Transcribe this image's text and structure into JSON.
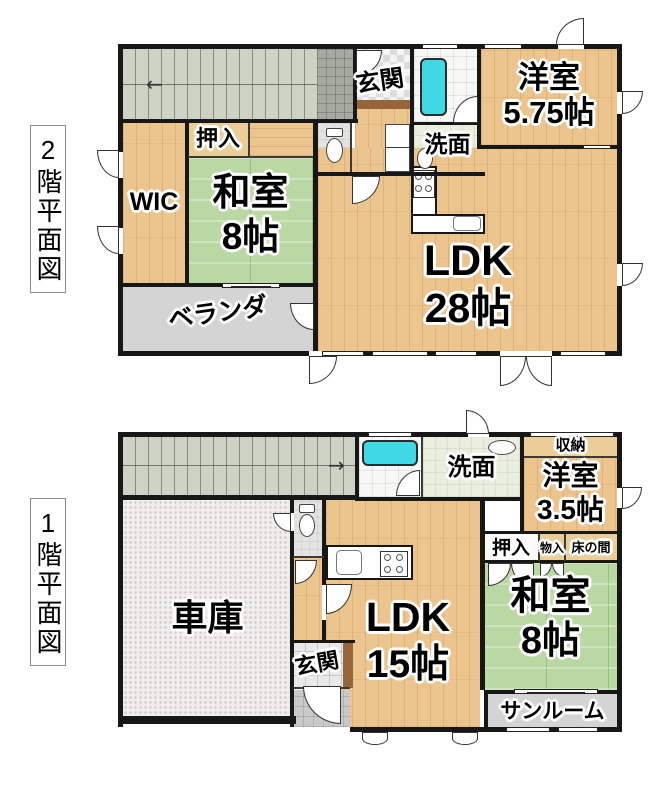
{
  "palette": {
    "wall": "#171717",
    "wood_floor": "#ecc58e",
    "tatami_green": "#b9d8a4",
    "stair_gray": "#ccd2c4",
    "veranda_gray": "#d4d4d4",
    "garage_gray": "#efeeec",
    "bathtub_cyan": "#3fd9e5",
    "washroom_green": "#e9efdf",
    "step_brown": "#96653a"
  },
  "floors": {
    "f2": {
      "side_label": "2階平面図",
      "stair_arrow": "←",
      "rooms": {
        "genkan": {
          "label": "玄関"
        },
        "yoshitsu": {
          "label": "洋室",
          "size": "5.75帖"
        },
        "senmen": {
          "label": "洗面"
        },
        "oshiire": {
          "label": "押入"
        },
        "washitsu": {
          "label": "和室",
          "size": "8帖"
        },
        "wic": {
          "label": "WIC"
        },
        "ldk": {
          "label": "LDK",
          "size": "28帖"
        },
        "veranda": {
          "label": "ベランダ"
        }
      }
    },
    "f1": {
      "side_label": "1階平面図",
      "stair_arrow": "→",
      "rooms": {
        "senmen": {
          "label": "洗面"
        },
        "shuno": {
          "label": "収納"
        },
        "yoshitsu": {
          "label": "洋室",
          "size": "3.5帖"
        },
        "oshiire": {
          "label": "押入"
        },
        "monoire": {
          "label": "物入"
        },
        "tokonoma": {
          "label": "床の間"
        },
        "shako": {
          "label": "車庫"
        },
        "ldk": {
          "label": "LDK",
          "size": "15帖"
        },
        "washitsu": {
          "label": "和室",
          "size": "8帖"
        },
        "genkan": {
          "label": "玄関"
        },
        "sunroom": {
          "label": "サンルーム"
        }
      }
    }
  }
}
